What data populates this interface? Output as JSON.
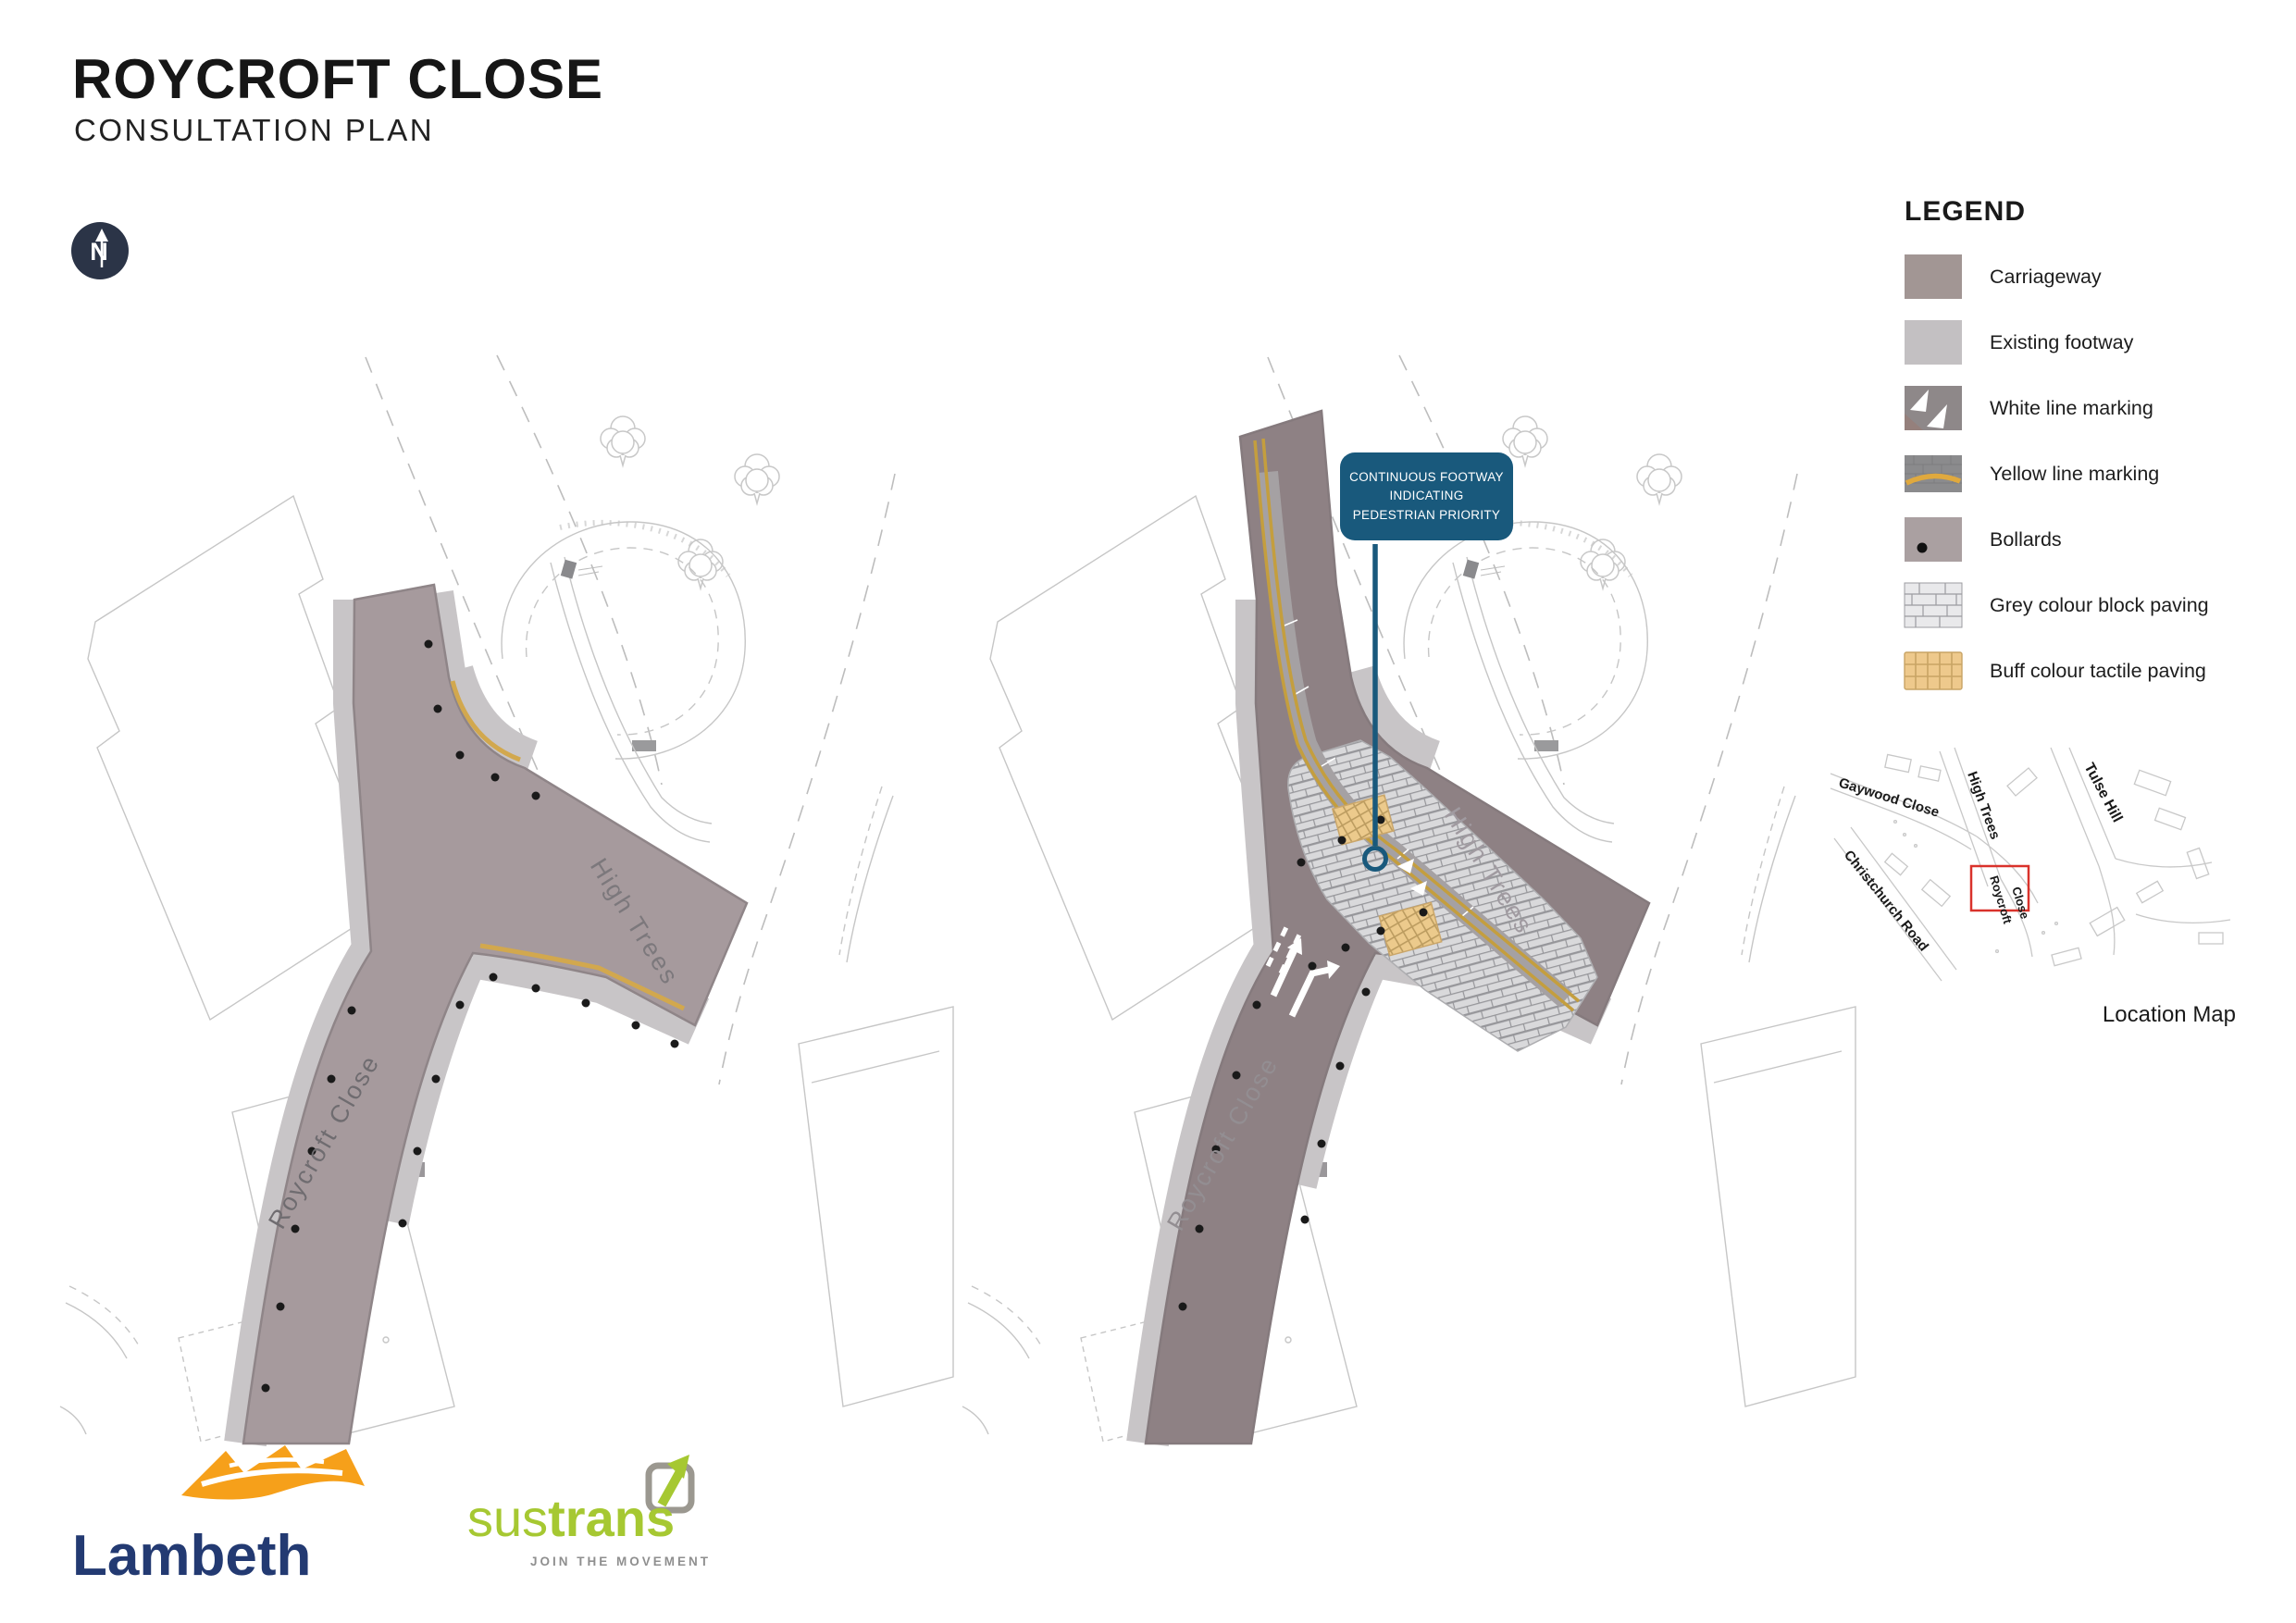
{
  "page": {
    "title": "ROYCROFT CLOSE",
    "subtitle": "CONSULTATION PLAN"
  },
  "north_arrow": {
    "label": "N"
  },
  "legend": {
    "title": "LEGEND",
    "items": [
      {
        "label": "Carriageway",
        "swatch": "carriageway"
      },
      {
        "label": "Existing footway",
        "swatch": "existing-footway"
      },
      {
        "label": "White line marking",
        "swatch": "white-line-marking"
      },
      {
        "label": "Yellow line marking",
        "swatch": "yellow-line-marking"
      },
      {
        "label": "Bollards",
        "swatch": "bollards"
      },
      {
        "label": "Grey colour block paving",
        "swatch": "grey-block-paving"
      },
      {
        "label": "Buff colour tactile paving",
        "swatch": "buff-tactile-paving"
      }
    ]
  },
  "plans": {
    "left": {
      "road_labels": {
        "high_trees": "High Trees",
        "roycroft_close": "Roycroft Close"
      }
    },
    "right": {
      "road_labels": {
        "high_trees": "High Trees",
        "roycroft_close": "Roycroft Close"
      },
      "callout_text": "CONTINUOUS FOOTWAY INDICATING PEDESTRIAN PRIORITY"
    }
  },
  "location_map": {
    "caption": "Location Map",
    "streets": {
      "gaywood": "Gaywood Close",
      "high_trees": "High Trees",
      "tulse_hill": "Tulse Hill",
      "christchurch": "Christchurch Road",
      "roycroft_1": "Roycroft",
      "roycroft_2": "Close"
    }
  },
  "logos": {
    "lambeth": {
      "name": "Lambeth"
    },
    "sustrans": {
      "name_light": "sus",
      "name_bold": "trans",
      "tagline": "JOIN THE MOVEMENT"
    }
  },
  "colors": {
    "carriageway_existing": "#a69a9d",
    "carriageway_proposed": "#8e8184",
    "footway": "#c8c5c7",
    "yellow_line": "#d2a84e",
    "block_paving": "#d9d9db",
    "tactile_paving": "#ecca8c",
    "bollard": "#1a1a1a",
    "callout_blue": "#19597c",
    "location_highlight_red": "#d9322b",
    "lambeth_navy": "#233a72",
    "lambeth_orange": "#f6a01a",
    "sustrans_green": "#a6c832"
  }
}
